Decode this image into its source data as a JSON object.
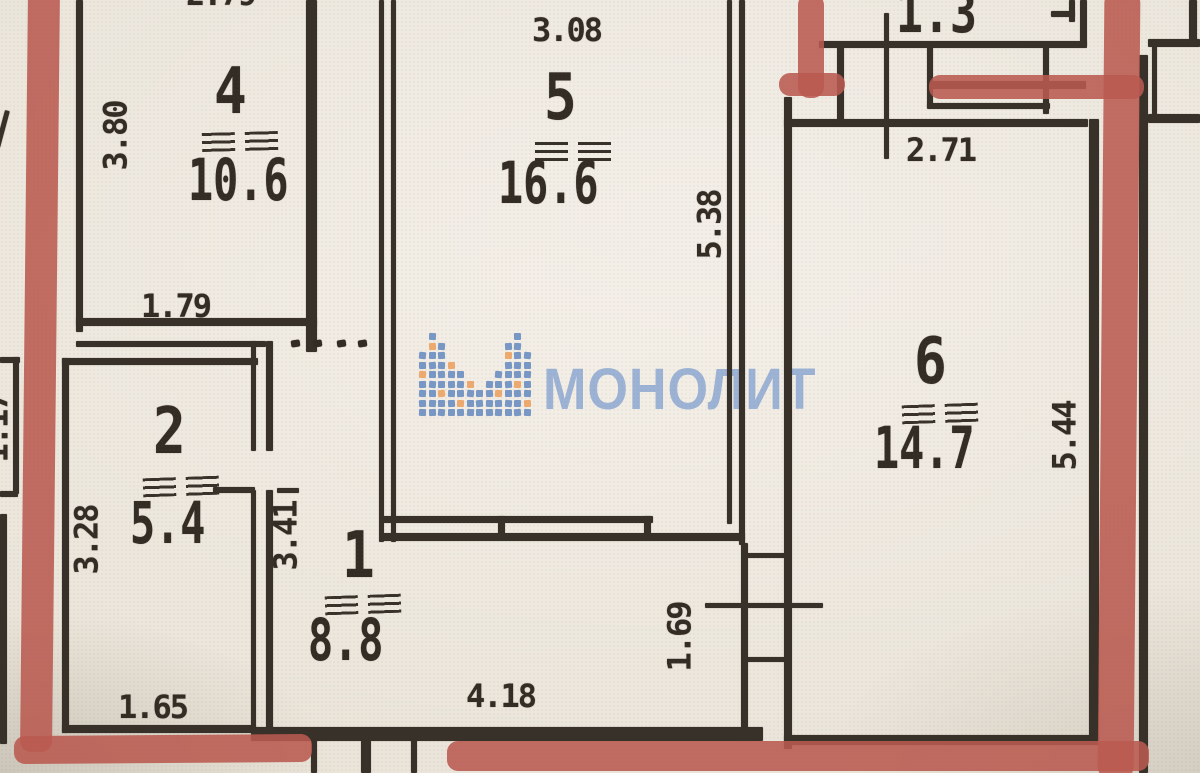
{
  "plan": {
    "rooms": {
      "room4": {
        "number": "4",
        "area": "10.6"
      },
      "room5": {
        "number": "5",
        "area": "16.6"
      },
      "room6": {
        "number": "6",
        "area": "14.7"
      },
      "room2": {
        "number": "2",
        "area": "5.4"
      },
      "room1": {
        "number": "1",
        "area": "8.8"
      }
    },
    "dimensions": {
      "room4_top_partial": "2.79",
      "room4_left": "3.80",
      "room4_bottom": "1.79",
      "room5_top": "3.08",
      "room5_right": "5.38",
      "balcony_area": "1.3",
      "room6_top": "2.71",
      "room6_right": "5.44",
      "room2_left": "3.28",
      "room2_right": "3.41",
      "room2_bottom": "1.65",
      "room1_bottom": "4.18",
      "shaft_right": "1.69",
      "left_edge_partial": "1.17"
    },
    "watermark": {
      "text": "МОНОЛИТ"
    },
    "colors": {
      "marker_red": "#b95a50",
      "ink": "#38312a",
      "watermark_blue": "#7c9cce",
      "logo_blue": "#5d84bd",
      "logo_orange": "#ea9a55",
      "paper": "#e9e3d8"
    }
  }
}
